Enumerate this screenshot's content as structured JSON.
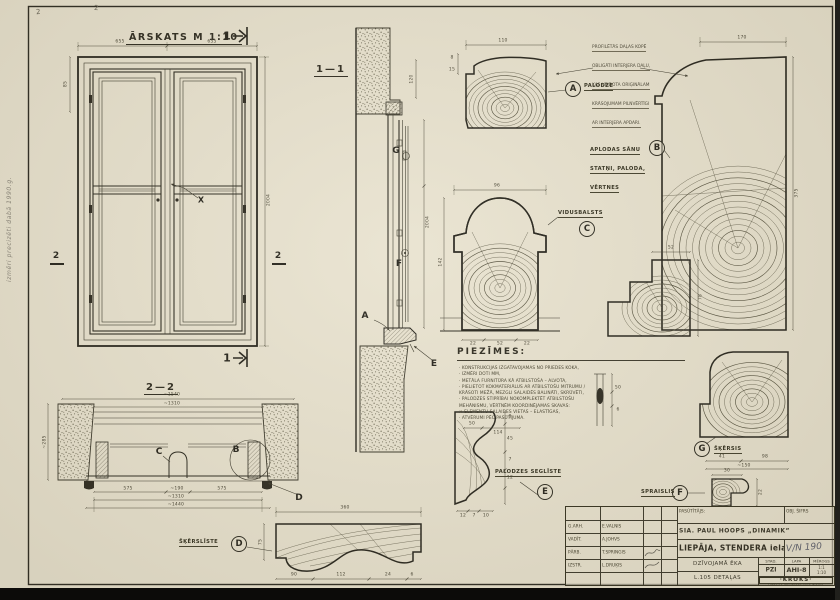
{
  "sheet": {
    "title": "ĀRSKATS  M 1:10",
    "section1_title": "1—1",
    "section2_title": "2—2",
    "cut1": "1",
    "cut2": "2",
    "x_mark": "X",
    "corner_mark1": "2",
    "corner_mark2": "2",
    "margin_note": "izmēri precizēti dabā 1990.g."
  },
  "details": {
    "a": {
      "letter": "A",
      "label": "PALODZE"
    },
    "b": {
      "letter": "B",
      "label_lines": [
        "APLODAS SĀNU",
        "STATŅI, PALODA,",
        "VĒRTNES"
      ]
    },
    "c": {
      "letter": "C",
      "label": "VIDUSBALSTS"
    },
    "d": {
      "letter": "D",
      "label": "ŠĶĒRSLĪSTE"
    },
    "e": {
      "letter": "E",
      "label": "PALODZES SEGLĪSTE"
    },
    "f": {
      "letter": "F",
      "label": "SPRAISLIS"
    },
    "g": {
      "letter": "G",
      "label": "ŠĶĒRSIS"
    }
  },
  "annotation": {
    "lines": [
      "PROFILĒTĀS DAĻAS KOPĒ",
      "OBLIGĀTI INTERJERA DAĻU,",
      "KAS VEIDOTA ORIĢINĀLAM",
      "KRĀSOJUMAM PILNVĒRTĪGI",
      "AR INTERJERA APDARI."
    ]
  },
  "notes": {
    "title": "PIEZĪMES:",
    "lines": [
      "· KONSTRUKCIJAS IZGATAVOJAMAS NO PRIEDES KOKA,",
      "· IZMĒRI DOTI MM,",
      "· METĀLA FURNITŪRA KĀ ATBILSTOŠA – ALVOTA,",
      "· PIELIETOT KOKMATERIĀLUS AR ATBILSTOŠU MITRUMU /",
      "  KRĀSOTI MEŽĀ, MEZGLI SALAIDĒS BALINĀTI, SKRŪVĒTI,",
      "· PALODZES STIPRĪBAI NOKOMPLEKTĒT ATBILSTOŠU",
      "  MEHĀNISMU, VĒRTNĒM KOORDINĒJAMAS SKAVAS:",
      "× ELEMENTU SALAIDES VIETAS – ELASTĪGAS,",
      "· ATVĒRUMI PĒC PASŪTĪJUMA."
    ]
  },
  "title_block": {
    "rows": [
      {
        "role": "G.ARH.",
        "name": "E.VALNIS"
      },
      {
        "role": "VADĪT.",
        "name": "A.JOHVS"
      },
      {
        "role": "PĀRB.",
        "name": "T.SPRINGIS"
      },
      {
        "role": "IZSTR.",
        "name": "L.DRUĶIS"
      }
    ],
    "client_label": "PASŪTĪTĀJS:",
    "obj_code_label": "OBJ. ŠIFRS",
    "client": "SIA. PAUL HOOPS „DINAMIK”",
    "address": "LIEPĀJA, STENDERA iela 11",
    "obj_code": "V/N 190",
    "stage_label": "STAD.",
    "sheet_label": "LAPA",
    "scale_label": "MĒROGS",
    "stage": "PZI",
    "sheet_no": "AHI-8",
    "scale1": "1:1",
    "scale2": "1:10",
    "building": "DZĪVOJAMĀ ĒKA",
    "drawing_title": "L.105 DETAĻAS",
    "firm": "·KROKS·",
    "firm_sub": "LIEPĀJAS PROJEKTĒŠANAS BIROJS"
  },
  "dims": {
    "elev_w1": "655",
    "elev_w2": "655",
    "elev_h": "2004",
    "elev_left": "85",
    "s11_h": "2004",
    "s11_top": "120",
    "a_w": "110",
    "a_t1": "8",
    "a_t2": "15",
    "b_w": "170",
    "b_side": "375",
    "c_w": "96",
    "c_h": "142",
    "c_b1": "22",
    "c_b2": "52",
    "c_b3": "22",
    "b2_w": "52",
    "b2_h": "78",
    "g_d1": "41",
    "g_d2": "98",
    "g_d3": "~150",
    "e_r1": "8",
    "e_r2": "45",
    "e_r3": "7",
    "e_r4": "12",
    "e_b1": "12",
    "e_b2": "7",
    "e_b3": "10",
    "f_top": "30",
    "f_side": "22",
    "d_w": "360",
    "d_h": "75",
    "d_b1": "90",
    "d_b2": "112",
    "d_b3": "24",
    "d_b4": "6",
    "s22_t1": "~1540",
    "s22_t2": "~1310",
    "s22_left": "~285",
    "s22_b1": "575",
    "s22_mid": "~190",
    "s22_b3": "575",
    "s22_b4": "~1310",
    "s22_b5": "~1440",
    "sk_d1": "50",
    "sk_d2": "6",
    "sk_b1": "50",
    "sk_b2": "114"
  }
}
